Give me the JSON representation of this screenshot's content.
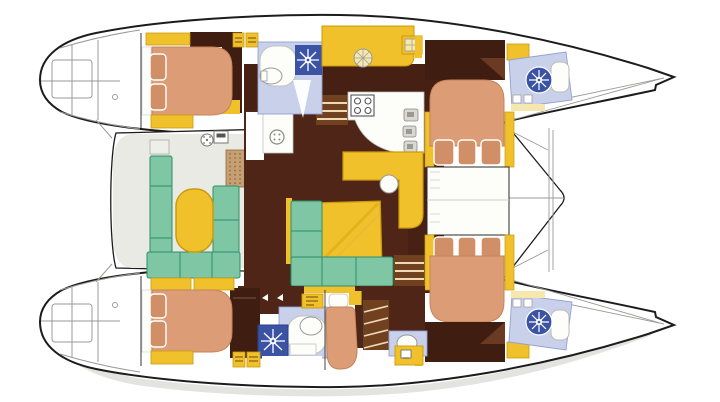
{
  "meta": {
    "subject": "catamaran-yacht-interior-floor-plan",
    "view": "top-down",
    "orientation": "bows-pointing-right"
  },
  "palette": {
    "outline": "#1c1c1c",
    "sketch": "#9a9a98",
    "shadow": "#dcdcd8",
    "deck_white": "#ffffff",
    "floor_brown": "#4e2517",
    "floor_brown_dk": "#3f1d11",
    "floor_brown_lt": "#6b3a22",
    "wood_step": "#71401f",
    "step_line": "#ecd9b8",
    "yellow": "#f0c12b",
    "yellow_dk": "#c99c0e",
    "pale_yellow": "#f6e7ae",
    "salmon": "#dc9c75",
    "salmon_dk": "#c5845c",
    "pillow": "#d18f67",
    "teal": "#7fc6a4",
    "teal_dk": "#2f8f68",
    "bath_floor": "#c8d0ea",
    "bath_edge": "#93a1d2",
    "bath_blue": "#3a53a4",
    "cockpit_floor": "#e9eae3",
    "teak": "#c6a072",
    "teak_dot": "#8a6a42",
    "fixture_white": "#fdfdfa",
    "fixture_line": "#b5b5b0",
    "appliance": "#d9d9d2"
  },
  "icons": [
    "shower-rose-sun-icon",
    "round-deck-hatch-icon",
    "square-deck-hatch-icon",
    "winch-icon",
    "stove-burners-icon",
    "toilet-icon",
    "helm-instrument-icon"
  ]
}
